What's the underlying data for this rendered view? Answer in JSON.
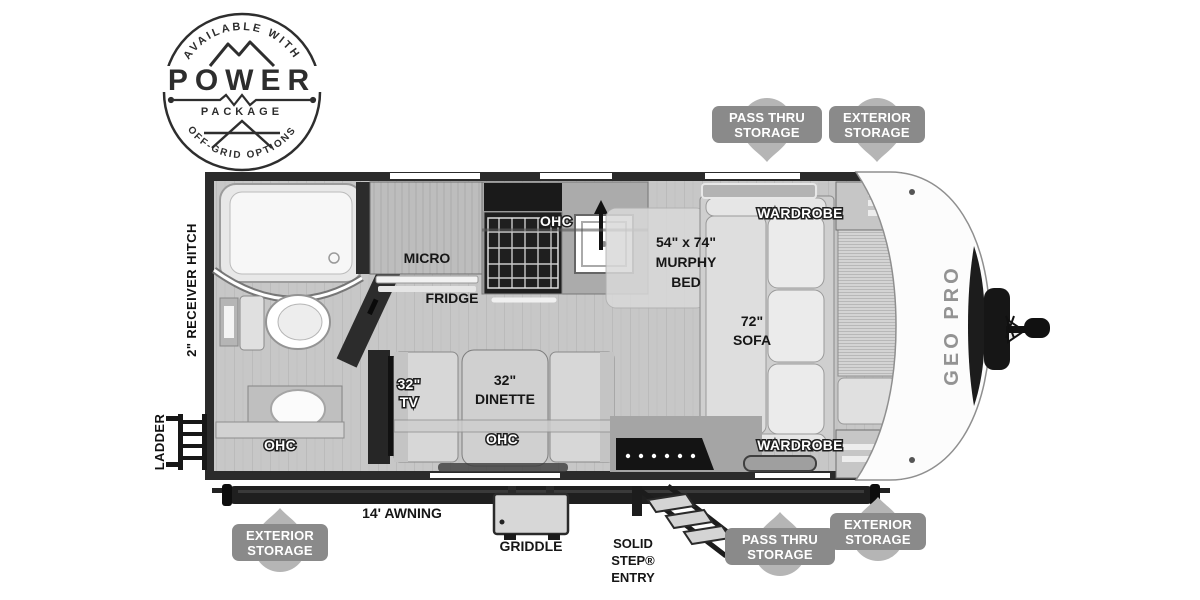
{
  "power_badge": {
    "top_arc": "AVAILABLE WITH",
    "title": "POWER",
    "subtitle": "PACKAGE",
    "bottom_arc": "OFF-GRID OPTIONS"
  },
  "callouts": {
    "top_pass_thru": {
      "line1": "PASS THRU",
      "line2": "STORAGE"
    },
    "top_exterior": {
      "line1": "EXTERIOR",
      "line2": "STORAGE"
    },
    "bottom_exterior_left": {
      "line1": "EXTERIOR",
      "line2": "STORAGE"
    },
    "bottom_pass_thru": {
      "line1": "PASS THRU",
      "line2": "STORAGE"
    },
    "bottom_exterior_right": {
      "line1": "EXTERIOR",
      "line2": "STORAGE"
    }
  },
  "exterior": {
    "receiver_hitch": "2\" RECEIVER HITCH",
    "ladder": "LADDER",
    "awning": "14' AWNING",
    "griddle": "GRIDDLE",
    "solid_step": {
      "line1": "SOLID",
      "line2": "STEP®",
      "line3": "ENTRY"
    },
    "brand": "GEO PRO"
  },
  "interior": {
    "micro": "MICRO",
    "fridge": "FRIDGE",
    "ohc_kitchen": "OHC",
    "murphy_bed": {
      "line1": "54\" x 74\"",
      "line2": "MURPHY",
      "line3": "BED"
    },
    "sofa": {
      "line1": "72\"",
      "line2": "SOFA"
    },
    "wardrobe_top": "WARDROBE",
    "wardrobe_bottom": "WARDROBE",
    "tv": {
      "line1": "32\"",
      "line2": "TV"
    },
    "dinette": {
      "line1": "32\"",
      "line2": "DINETTE"
    },
    "ohc_dinette": "OHC",
    "ohc_bath": "OHC"
  },
  "icons": {
    "badge": "power-package-badge",
    "ladder": "ladder-icon",
    "griddle": "griddle-icon",
    "steps": "entry-steps-icon",
    "awning": "awning-bar",
    "hitch": "tongue-jack-icon"
  },
  "colors": {
    "wall": "#2b2b2b",
    "floor": "#c7c7c7",
    "callout_pill": "#8a8a8a",
    "callout_balloon": "#b5b5b5",
    "label_dark": "#161616",
    "label_white": "#ffffff"
  }
}
